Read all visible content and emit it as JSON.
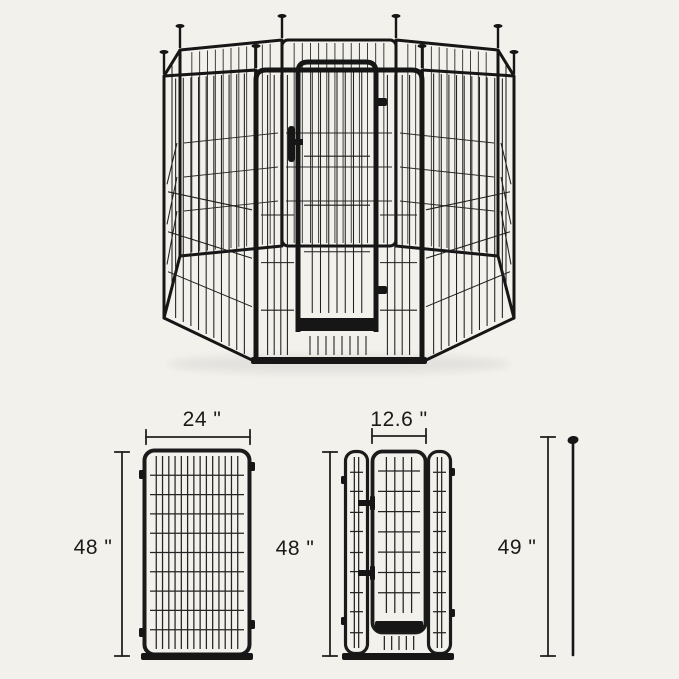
{
  "background_color": "#f3f1ec",
  "line_color": "#1a1a1a",
  "frame_color": "#161616",
  "dimensions": {
    "panel": {
      "width": "24 \"",
      "height": "48 \""
    },
    "door_panel": {
      "door_width": "12.6 \"",
      "height": "48 \""
    },
    "ground_stake": {
      "height": "49 \""
    }
  }
}
